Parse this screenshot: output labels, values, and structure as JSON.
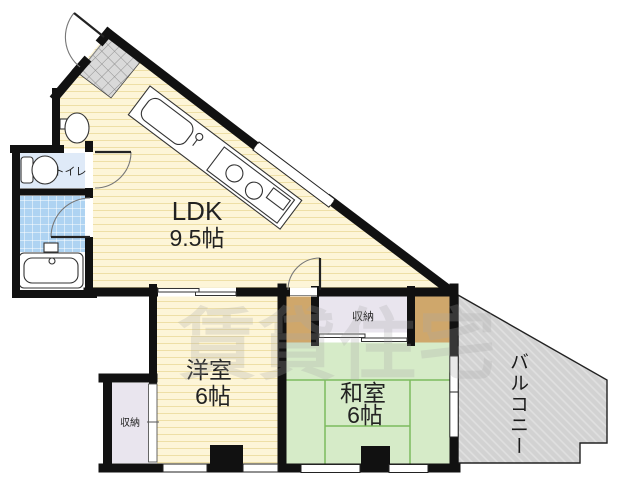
{
  "watermark": "賃貸住宅",
  "rooms": {
    "ldk": {
      "label": "LDK",
      "area": "9.5帖"
    },
    "western": {
      "label": "洋室",
      "area": "6帖"
    },
    "japanese": {
      "label": "和室",
      "area": "6帖"
    }
  },
  "labels": {
    "toilet": "トイレ",
    "balcony": "バルコニー",
    "storage_main": "収納",
    "storage_west": "収納"
  },
  "colors": {
    "wall": "#111111",
    "cream": "#fdf5d8",
    "cream_line": "#eedfa6",
    "tatami": "#d6ebc8",
    "tatami_line": "#7cbb5e",
    "tile": "#aed3f2",
    "toilet_room": "#dfeaf8",
    "storage": "#e9e5ee",
    "wood": "#cfa76b",
    "balcony": "#d2d2d2",
    "balcony_line": "#e0e0e0",
    "genkan": "#d9d9d9",
    "genkan_line": "#8f8f8f",
    "text": "#222222",
    "watermark": "#a8a8a8"
  }
}
